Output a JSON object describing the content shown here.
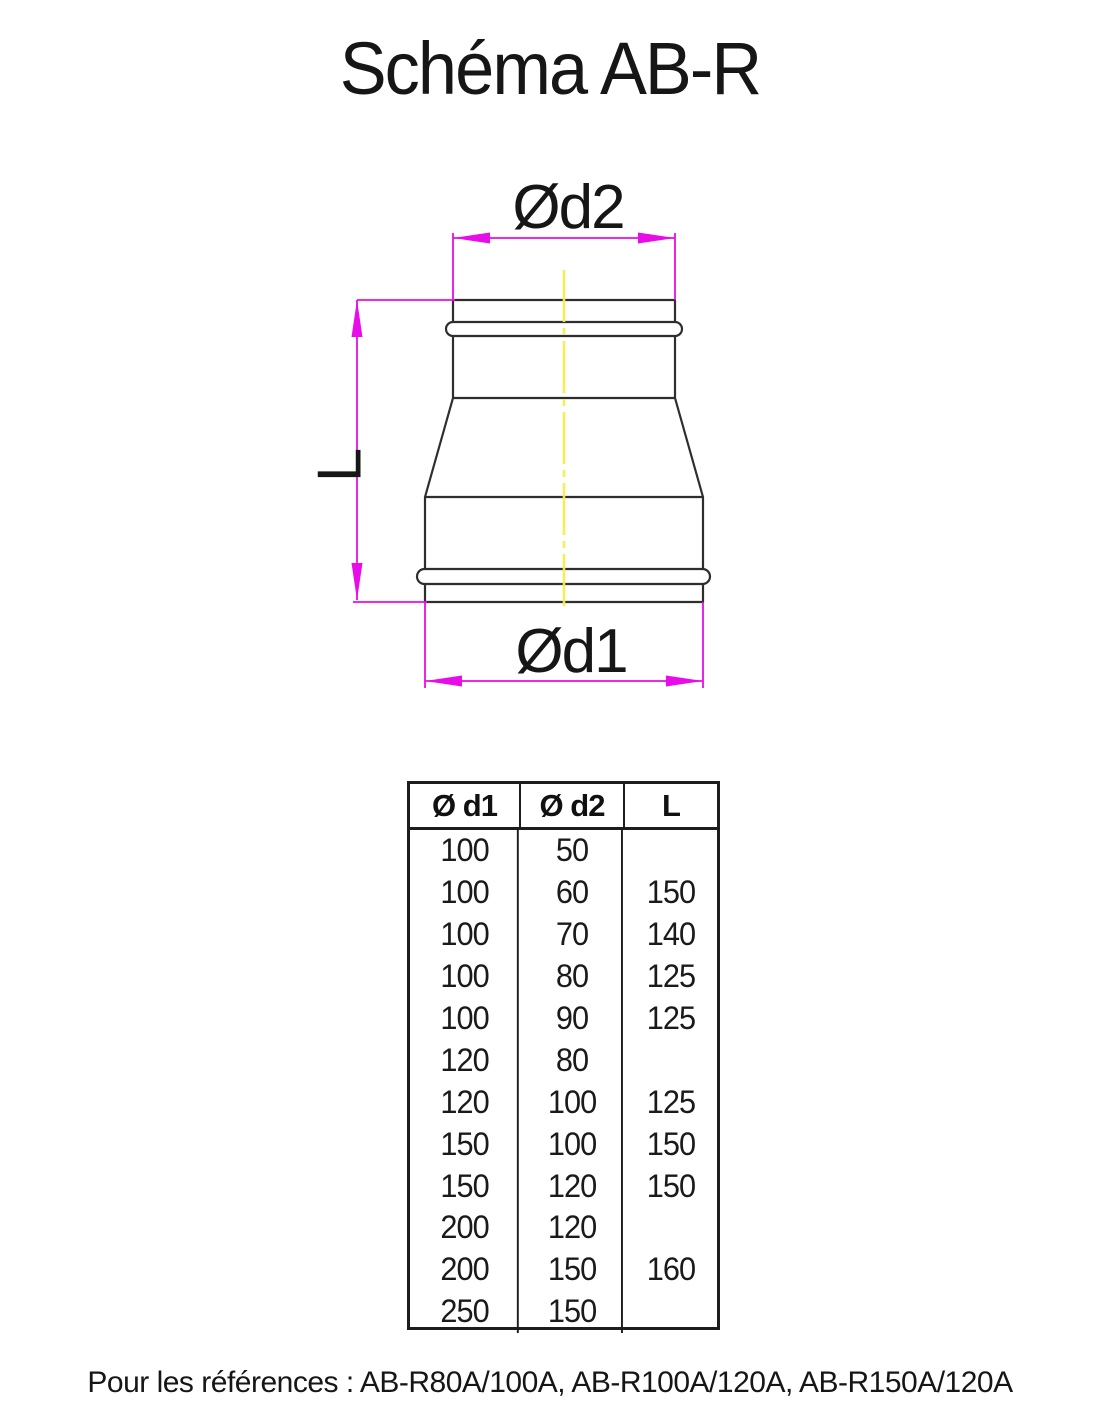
{
  "title": "Schéma AB-R",
  "diagram": {
    "labels": {
      "d2": "Ød2",
      "d1": "Ød1",
      "length": "L"
    },
    "colors": {
      "dimension": "#E80CE8",
      "centerline": "#F6EE4E",
      "outline": "#2E2E2E"
    }
  },
  "table": {
    "headers": [
      "Ø d1",
      "Ø d2",
      "L"
    ],
    "rows": [
      [
        "100",
        "50",
        ""
      ],
      [
        "100",
        "60",
        "150"
      ],
      [
        "100",
        "70",
        "140"
      ],
      [
        "100",
        "80",
        "125"
      ],
      [
        "100",
        "90",
        "125"
      ],
      [
        "120",
        "80",
        ""
      ],
      [
        "120",
        "100",
        "125"
      ],
      [
        "150",
        "100",
        "150"
      ],
      [
        "150",
        "120",
        "150"
      ],
      [
        "200",
        "120",
        ""
      ],
      [
        "200",
        "150",
        "160"
      ],
      [
        "250",
        "150",
        ""
      ]
    ]
  },
  "footer": "Pour les références : AB-R80A/100A, AB-R100A/120A, AB-R150A/120A"
}
